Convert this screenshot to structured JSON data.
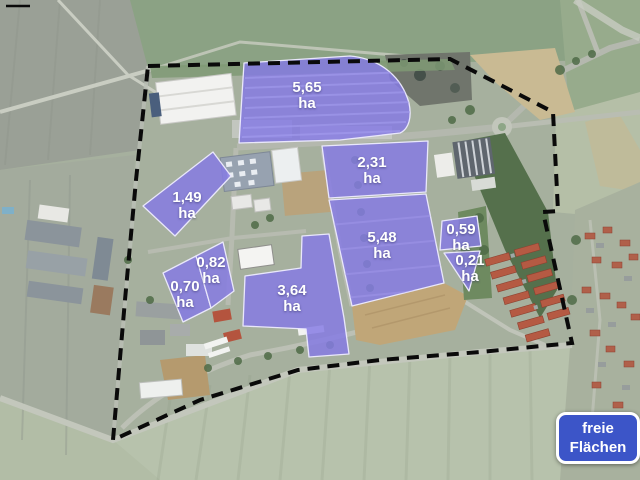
{
  "app": {
    "type": "aerial-site-plan",
    "language": "de"
  },
  "legend": {
    "line1": "freie",
    "line2": "Flächen"
  },
  "parcels": [
    {
      "id": "5-65",
      "value": "5,65",
      "unit": "ha",
      "area_ha": 5.65
    },
    {
      "id": "2-31",
      "value": "2,31",
      "unit": "ha",
      "area_ha": 2.31
    },
    {
      "id": "5-48",
      "value": "5,48",
      "unit": "ha",
      "area_ha": 5.48
    },
    {
      "id": "1-49",
      "value": "1,49",
      "unit": "ha",
      "area_ha": 1.49
    },
    {
      "id": "0-82",
      "value": "0,82",
      "unit": "ha",
      "area_ha": 0.82
    },
    {
      "id": "0-70",
      "value": "0,70",
      "unit": "ha",
      "area_ha": 0.7
    },
    {
      "id": "3-64",
      "value": "3,64",
      "unit": "ha",
      "area_ha": 3.64
    },
    {
      "id": "0-59",
      "value": "0,59",
      "unit": "ha",
      "area_ha": 0.59
    },
    {
      "id": "0-21",
      "value": "0,21",
      "unit": "ha",
      "area_ha": 0.21
    }
  ],
  "colors": {
    "parcel_fill": "#857be4",
    "parcel_border": "#e9e7fb",
    "boundary_color": "#0a0a0a",
    "legend_bg": "#3c55c8",
    "legend_text": "#ffffff",
    "label_text": "#ffffff"
  }
}
